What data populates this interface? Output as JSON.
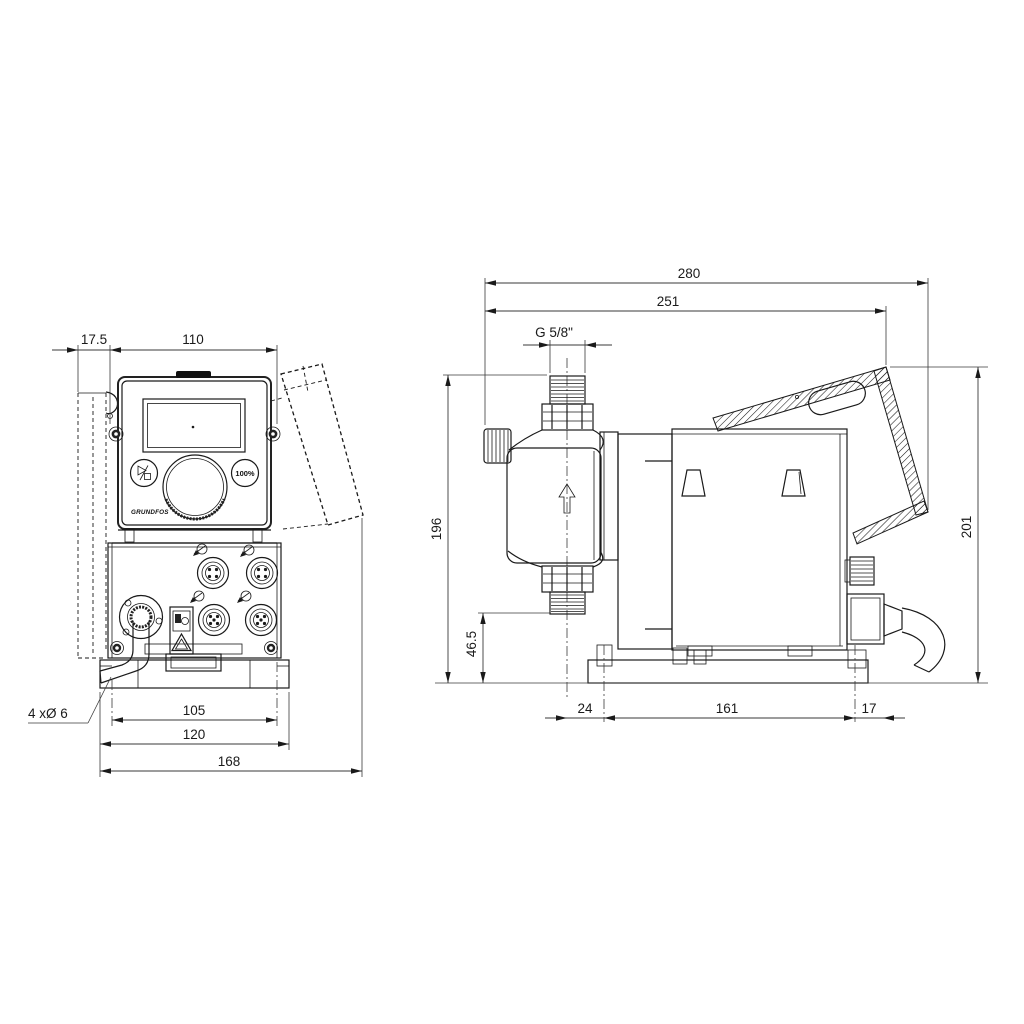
{
  "front_view": {
    "dims": {
      "offset": "17.5",
      "width": "110",
      "hole_spacing": "105",
      "plate_width": "120",
      "overall_width": "168"
    },
    "hole_note": "4 xØ 6",
    "panel": {
      "capacity_button": "100%",
      "logo": "GRUNDFOS"
    }
  },
  "side_view": {
    "dims": {
      "overall_depth": "280",
      "depth_to_hood": "251",
      "thread": "G 5/8\"",
      "height_suction": "196",
      "height_inlet": "46.5",
      "front_offset": "24",
      "hole_spacing": "161",
      "rear_offset": "17",
      "overall_height": "201"
    }
  },
  "colors": {
    "line": "#1a1a1a",
    "background": "#ffffff"
  }
}
